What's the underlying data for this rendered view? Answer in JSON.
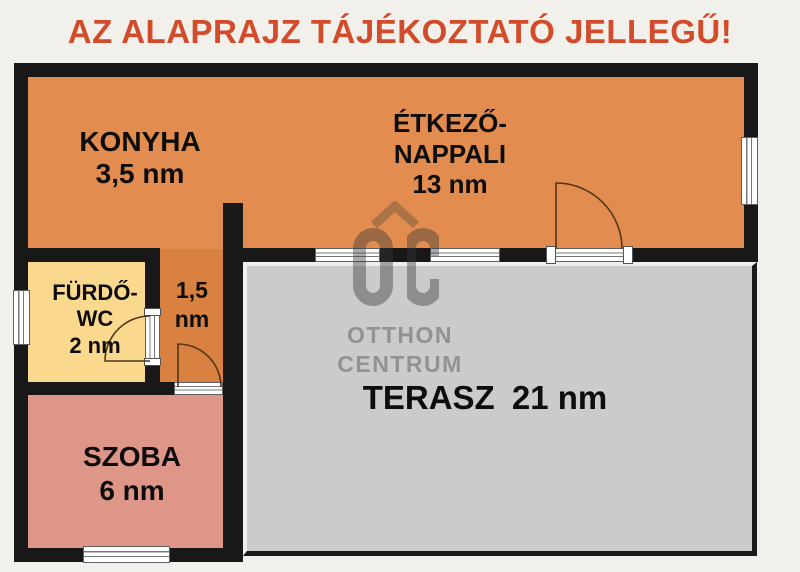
{
  "title": "AZ ALAPRAJZ TÁJÉKOZTATÓ JELLEGŰ!",
  "unit": "nm",
  "rooms": {
    "konyha": {
      "name": "KONYHA",
      "area": "3,5 nm"
    },
    "etkezo_nappali": {
      "name_lines": [
        "ÉTKEZŐ-",
        "NAPPALI"
      ],
      "area": "13 nm"
    },
    "furdo_wc": {
      "name_lines": [
        "FÜRDŐ-",
        "WC"
      ],
      "area": "2 nm"
    },
    "kozlekedo": {
      "area_lines": [
        "1,5",
        "nm"
      ]
    },
    "szoba": {
      "name": "SZOBA",
      "area": "6 nm"
    },
    "terasz": {
      "name": "TERASZ",
      "area": "21 nm"
    }
  },
  "watermark": {
    "logo": "OC",
    "name_lines": [
      "OTTHON",
      "CENTRUM"
    ]
  },
  "colors": {
    "title": "#d24c2c",
    "background": "#f2f0ea",
    "wall": "#181818",
    "room_orange": "#e28d4f",
    "hallway_orange": "#d98140",
    "bathroom_yellow": "#fad88e",
    "szoba_pink": "#de9689",
    "terasz_gray": "#cbcbca",
    "door_arc": "#53351a",
    "watermark_gray": "#979797"
  }
}
